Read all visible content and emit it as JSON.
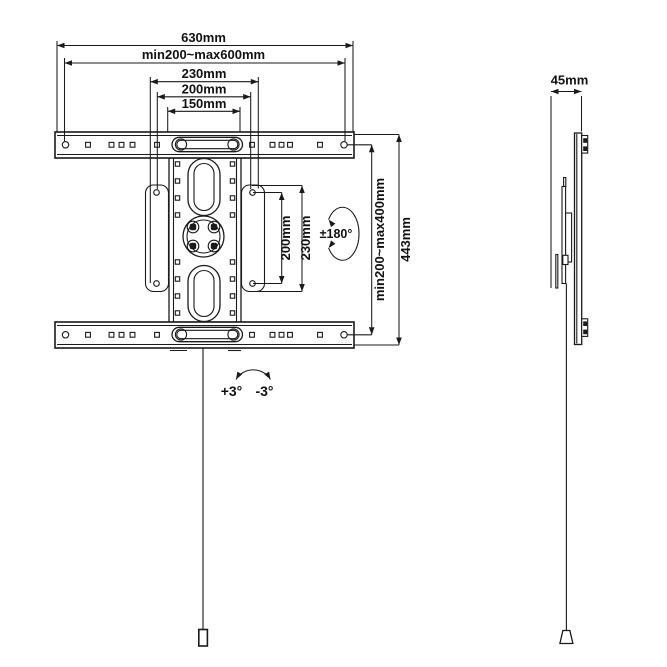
{
  "drawing": {
    "colors": {
      "line": "#1a1a1a",
      "text": "#111111",
      "background": "#ffffff"
    },
    "front": {
      "horizontal_dims": [
        {
          "label": "630mm"
        },
        {
          "label": "min200~max600mm"
        },
        {
          "label": "230mm"
        },
        {
          "label": "200mm"
        },
        {
          "label": "150mm"
        }
      ],
      "vertical_dims": [
        {
          "label": "200mm"
        },
        {
          "label": "230mm"
        },
        {
          "label": "min200~max400mm"
        },
        {
          "label": "443mm"
        }
      ],
      "swivel_label": "±180°",
      "tilt_up_label": "+3°",
      "tilt_down_label": "-3°"
    },
    "side": {
      "depth_label": "45mm"
    }
  }
}
